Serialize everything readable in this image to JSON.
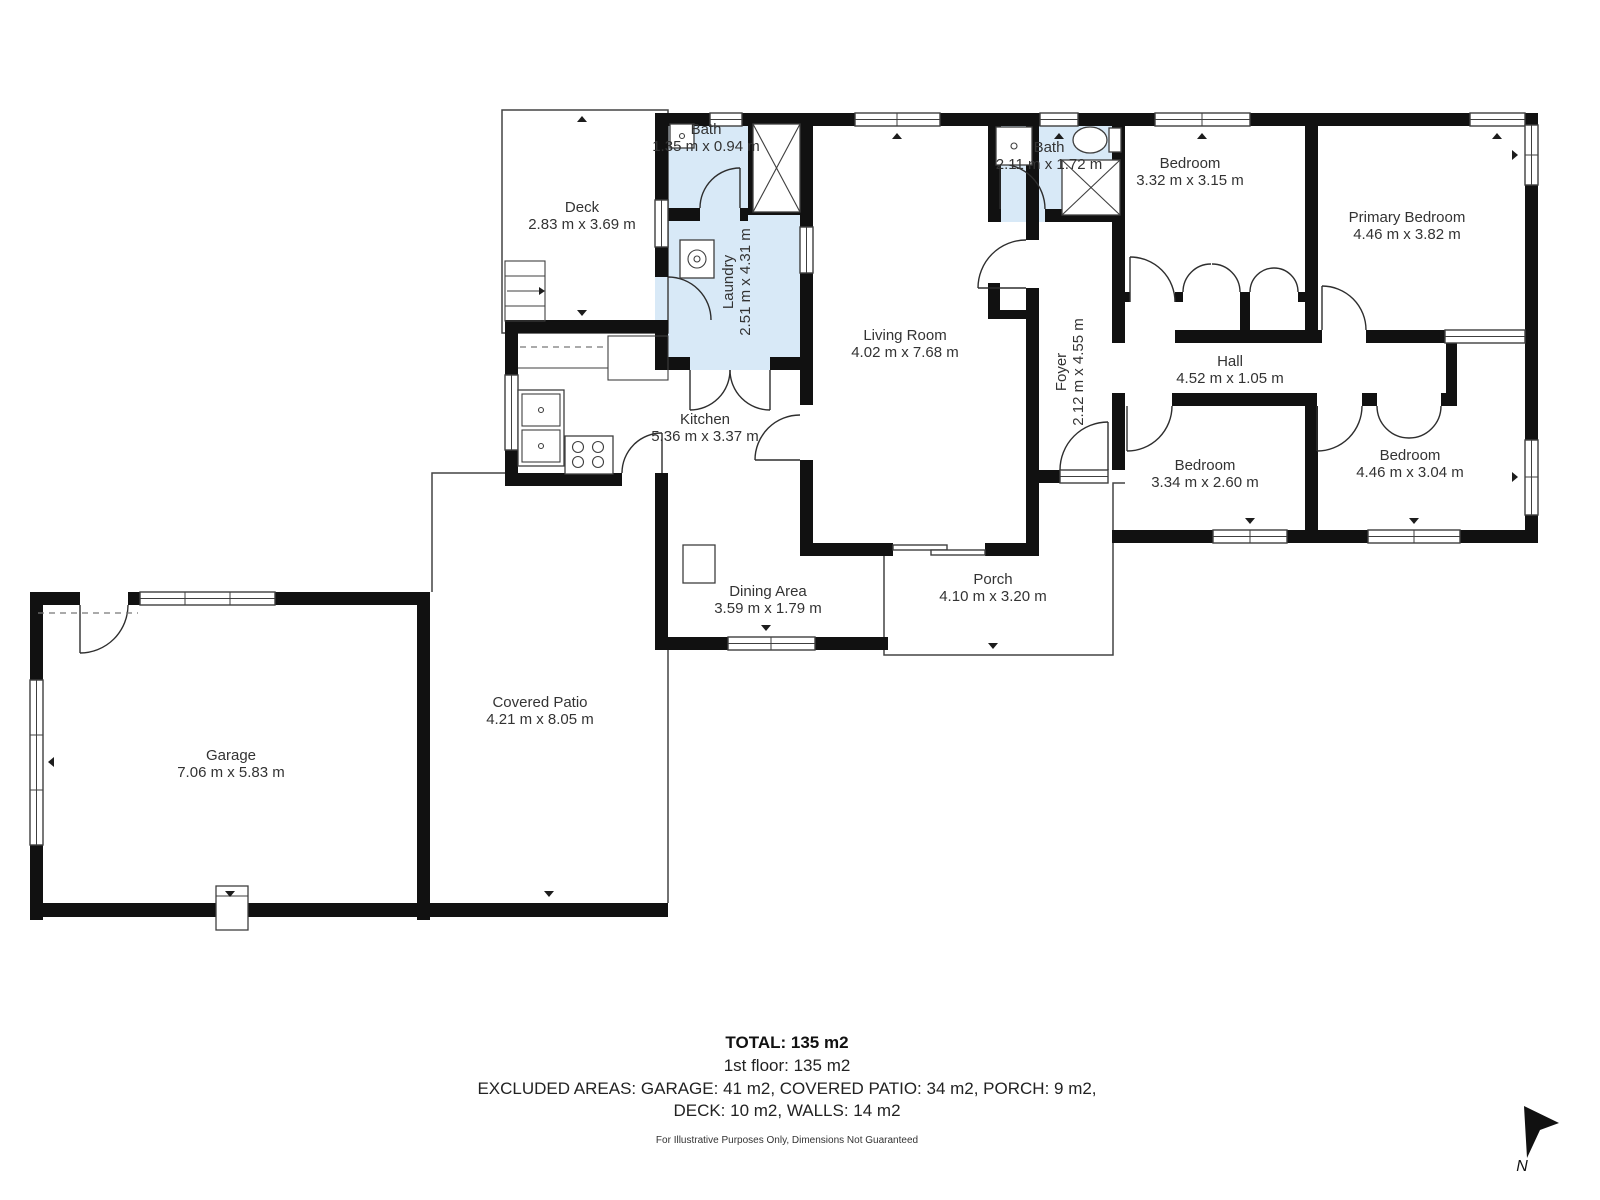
{
  "rooms": {
    "deck": {
      "name": "Deck",
      "dims": "2.83 m x 3.69 m"
    },
    "bath1": {
      "name": "Bath",
      "dims": "1.35 m x 0.94 m"
    },
    "laundry": {
      "name": "Laundry",
      "dims": "2.51 m x 4.31 m"
    },
    "kitchen": {
      "name": "Kitchen",
      "dims": "5.36 m x 3.37 m"
    },
    "living": {
      "name": "Living Room",
      "dims": "4.02 m x 7.68 m"
    },
    "bath2": {
      "name": "Bath",
      "dims": "2.11 m x 1.72 m"
    },
    "foyer": {
      "name": "Foyer",
      "dims": "2.12 m x 4.55 m"
    },
    "bedroom1": {
      "name": "Bedroom",
      "dims": "3.32 m x 3.15 m"
    },
    "primary": {
      "name": "Primary Bedroom",
      "dims": "4.46 m x 3.82 m"
    },
    "hall": {
      "name": "Hall",
      "dims": "4.52 m x 1.05 m"
    },
    "bedroom2": {
      "name": "Bedroom",
      "dims": "3.34 m x 2.60 m"
    },
    "bedroom3": {
      "name": "Bedroom",
      "dims": "4.46 m x 3.04 m"
    },
    "dining": {
      "name": "Dining Area",
      "dims": "3.59 m x 1.79 m"
    },
    "porch": {
      "name": "Porch",
      "dims": "4.10 m x 3.20 m"
    },
    "patio": {
      "name": "Covered Patio",
      "dims": "4.21 m x 8.05 m"
    },
    "garage": {
      "name": "Garage",
      "dims": "7.06 m x 5.83 m"
    }
  },
  "summary": {
    "total": "TOTAL: 135 m2",
    "floor": "1st floor: 135 m2",
    "excluded1": "EXCLUDED AREAS: GARAGE: 41 m2, COVERED PATIO: 34 m2, PORCH: 9 m2,",
    "excluded2": "DECK: 10 m2, WALLS: 14 m2",
    "disclaimer": "For Illustrative Purposes Only, Dimensions Not Guaranteed"
  },
  "compass": {
    "label": "N"
  },
  "colors": {
    "wall": "#111111",
    "wet": "#d8e9f7",
    "line": "#444444",
    "text": "#333333"
  }
}
